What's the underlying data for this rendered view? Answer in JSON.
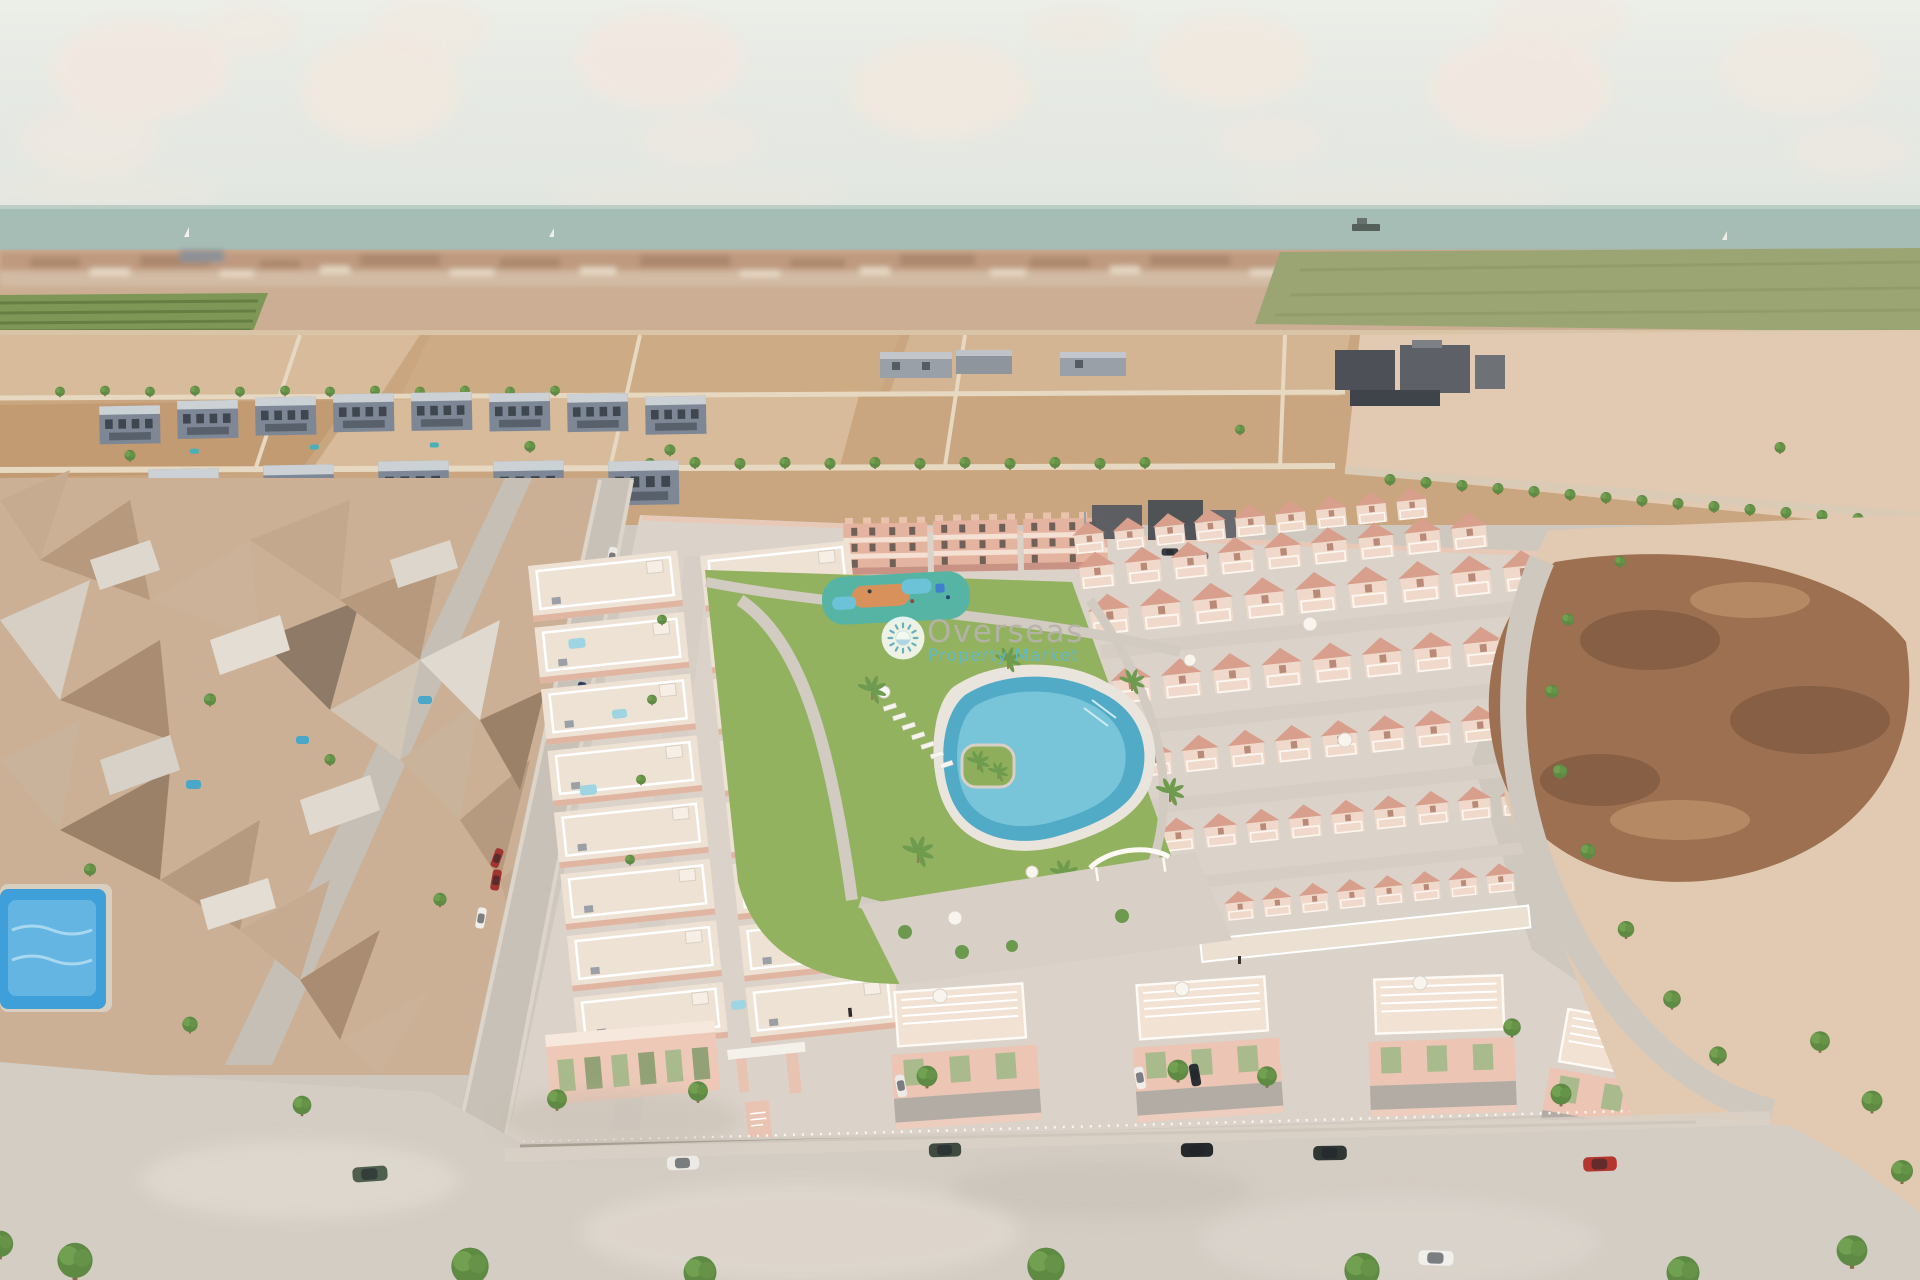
{
  "image": {
    "kind": "aerial-3d-architectural-render",
    "subject": "Bird's-eye render of a new-build salmon-pink residential complex with communal lagoon pool and gardens, set in an existing coastal neighbourhood with vacant plots and the sea on the horizon"
  },
  "watermark": {
    "brand": "Overseas",
    "tagline": "Property Market",
    "icon": "sun-icon",
    "badge_color": "#ffffff",
    "brand_color": "#b7b2ab",
    "tagline_color": "#5fb9c9",
    "sun_color": "#62b3c4"
  },
  "palette": {
    "sky": "#e7eae5",
    "cloud": "#f1e8df",
    "sea": "#a6bdb5",
    "far_city": "#cbae93",
    "field_green": "#9aa573",
    "orchard_green": "#7e9757",
    "sand_mid": "#c9a67f",
    "sand_light": "#d8bb9a",
    "sand_pink": "#e2c9b1",
    "dirt_brown": "#9c7050",
    "dirt_dark": "#7f5a42",
    "road": "#d4cdc4",
    "street": "#c8c1b7",
    "mesh_tan": "#cbb096",
    "estate_blue": "#7e8795",
    "estate_roof": "#ccd1d6",
    "dev_pavement": "#dbd2c9",
    "dev_wall": "#ecc5b4",
    "dev_cream": "#f0d9ca",
    "dev_salmon": "#d89f8c",
    "window_green": "#a9ba8c",
    "lawn": "#8fae5c",
    "pool_blue": "#52abc6",
    "pool_light": "#7fc8dc",
    "plunge_pool": "#9fd4e2",
    "neighbour_pool": "#3f9fd8",
    "tree_green": "#5e8a44",
    "car_white": "#eceae5",
    "car_black": "#26292c",
    "car_green": "#4e5f4e",
    "car_red": "#b5352f"
  },
  "scene": {
    "features": [
      "sky-with-clouds",
      "mediterranean-sea",
      "cargo-ship",
      "sailboats",
      "coastal-town-horizon",
      "green-farm-fields",
      "orchard-rows",
      "vacant-plot-grid",
      "warehouse-buildings",
      "grey-apartment-estate",
      "photogrammetry-neighbourhood-mesh",
      "neighbourhood-pools",
      "new-development",
      "apartment-blocks",
      "townhouse-rows",
      "roof-terraces-with-plunge-pools",
      "communal-garden",
      "lagoon-pool",
      "sun-loungers",
      "kids-playground",
      "palm-trees",
      "semi-detached-villas",
      "entrance-gate",
      "street-trees",
      "parked-cars",
      "vacant-dirt-lot"
    ]
  }
}
